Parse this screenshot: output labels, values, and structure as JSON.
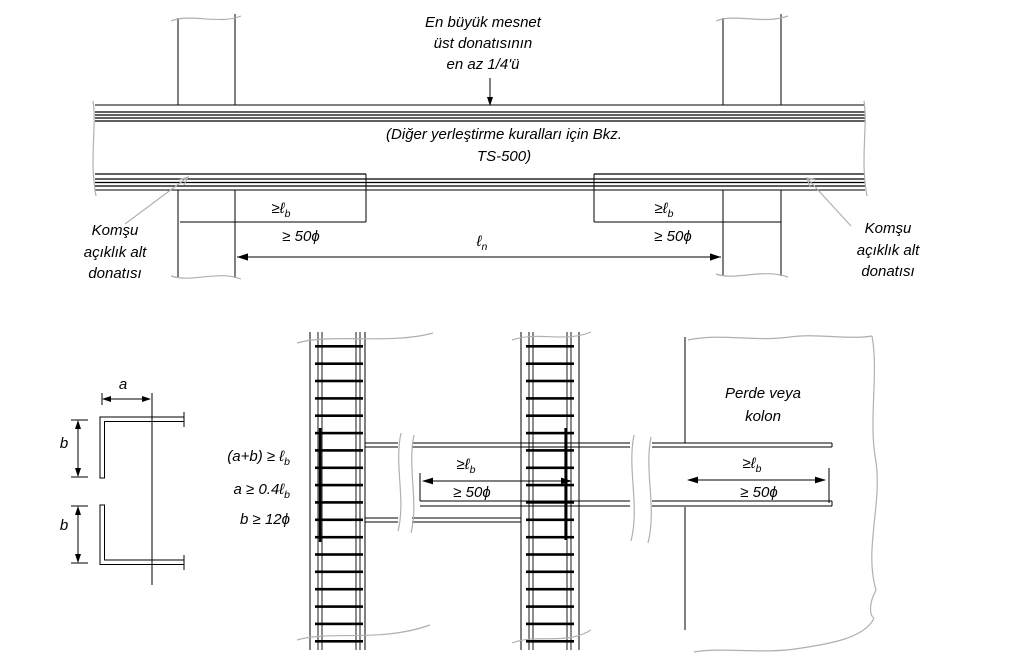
{
  "figure": {
    "top": {
      "note_top": [
        "En büyük mesnet",
        "üst donatısının",
        "en az 1/4'ü"
      ],
      "note_mid": [
        "(Diğer yerleştirme kuralları için Bkz.",
        "TS-500)"
      ],
      "left_label": [
        "Komşu",
        "açıklık alt",
        "donatısı"
      ],
      "right_label": [
        "Komşu",
        "açıklık alt",
        "donatısı"
      ]
    },
    "bottom": {
      "hook_dims": {
        "a": "a",
        "b": "b"
      },
      "formulas": [
        {
          "pre": "(a+b) ≥ ",
          "base": "ℓ",
          "sub": "b"
        },
        {
          "pre": "a ≥ 0.4",
          "base": "ℓ",
          "sub": "b"
        },
        {
          "pre": "b ≥ 12",
          "base": "ϕ",
          "sub": ""
        }
      ],
      "wall_label": [
        "Perde veya",
        "kolon"
      ]
    },
    "shared": {
      "geq_lb": {
        "pre": "≥",
        "base": "ℓ",
        "sub": "b"
      },
      "fifty_phi": "≥ 50ϕ",
      "ln": {
        "base": "ℓ",
        "sub": "n"
      }
    },
    "colors": {
      "line": "#000000",
      "break_line": "#b0b0b0"
    }
  }
}
